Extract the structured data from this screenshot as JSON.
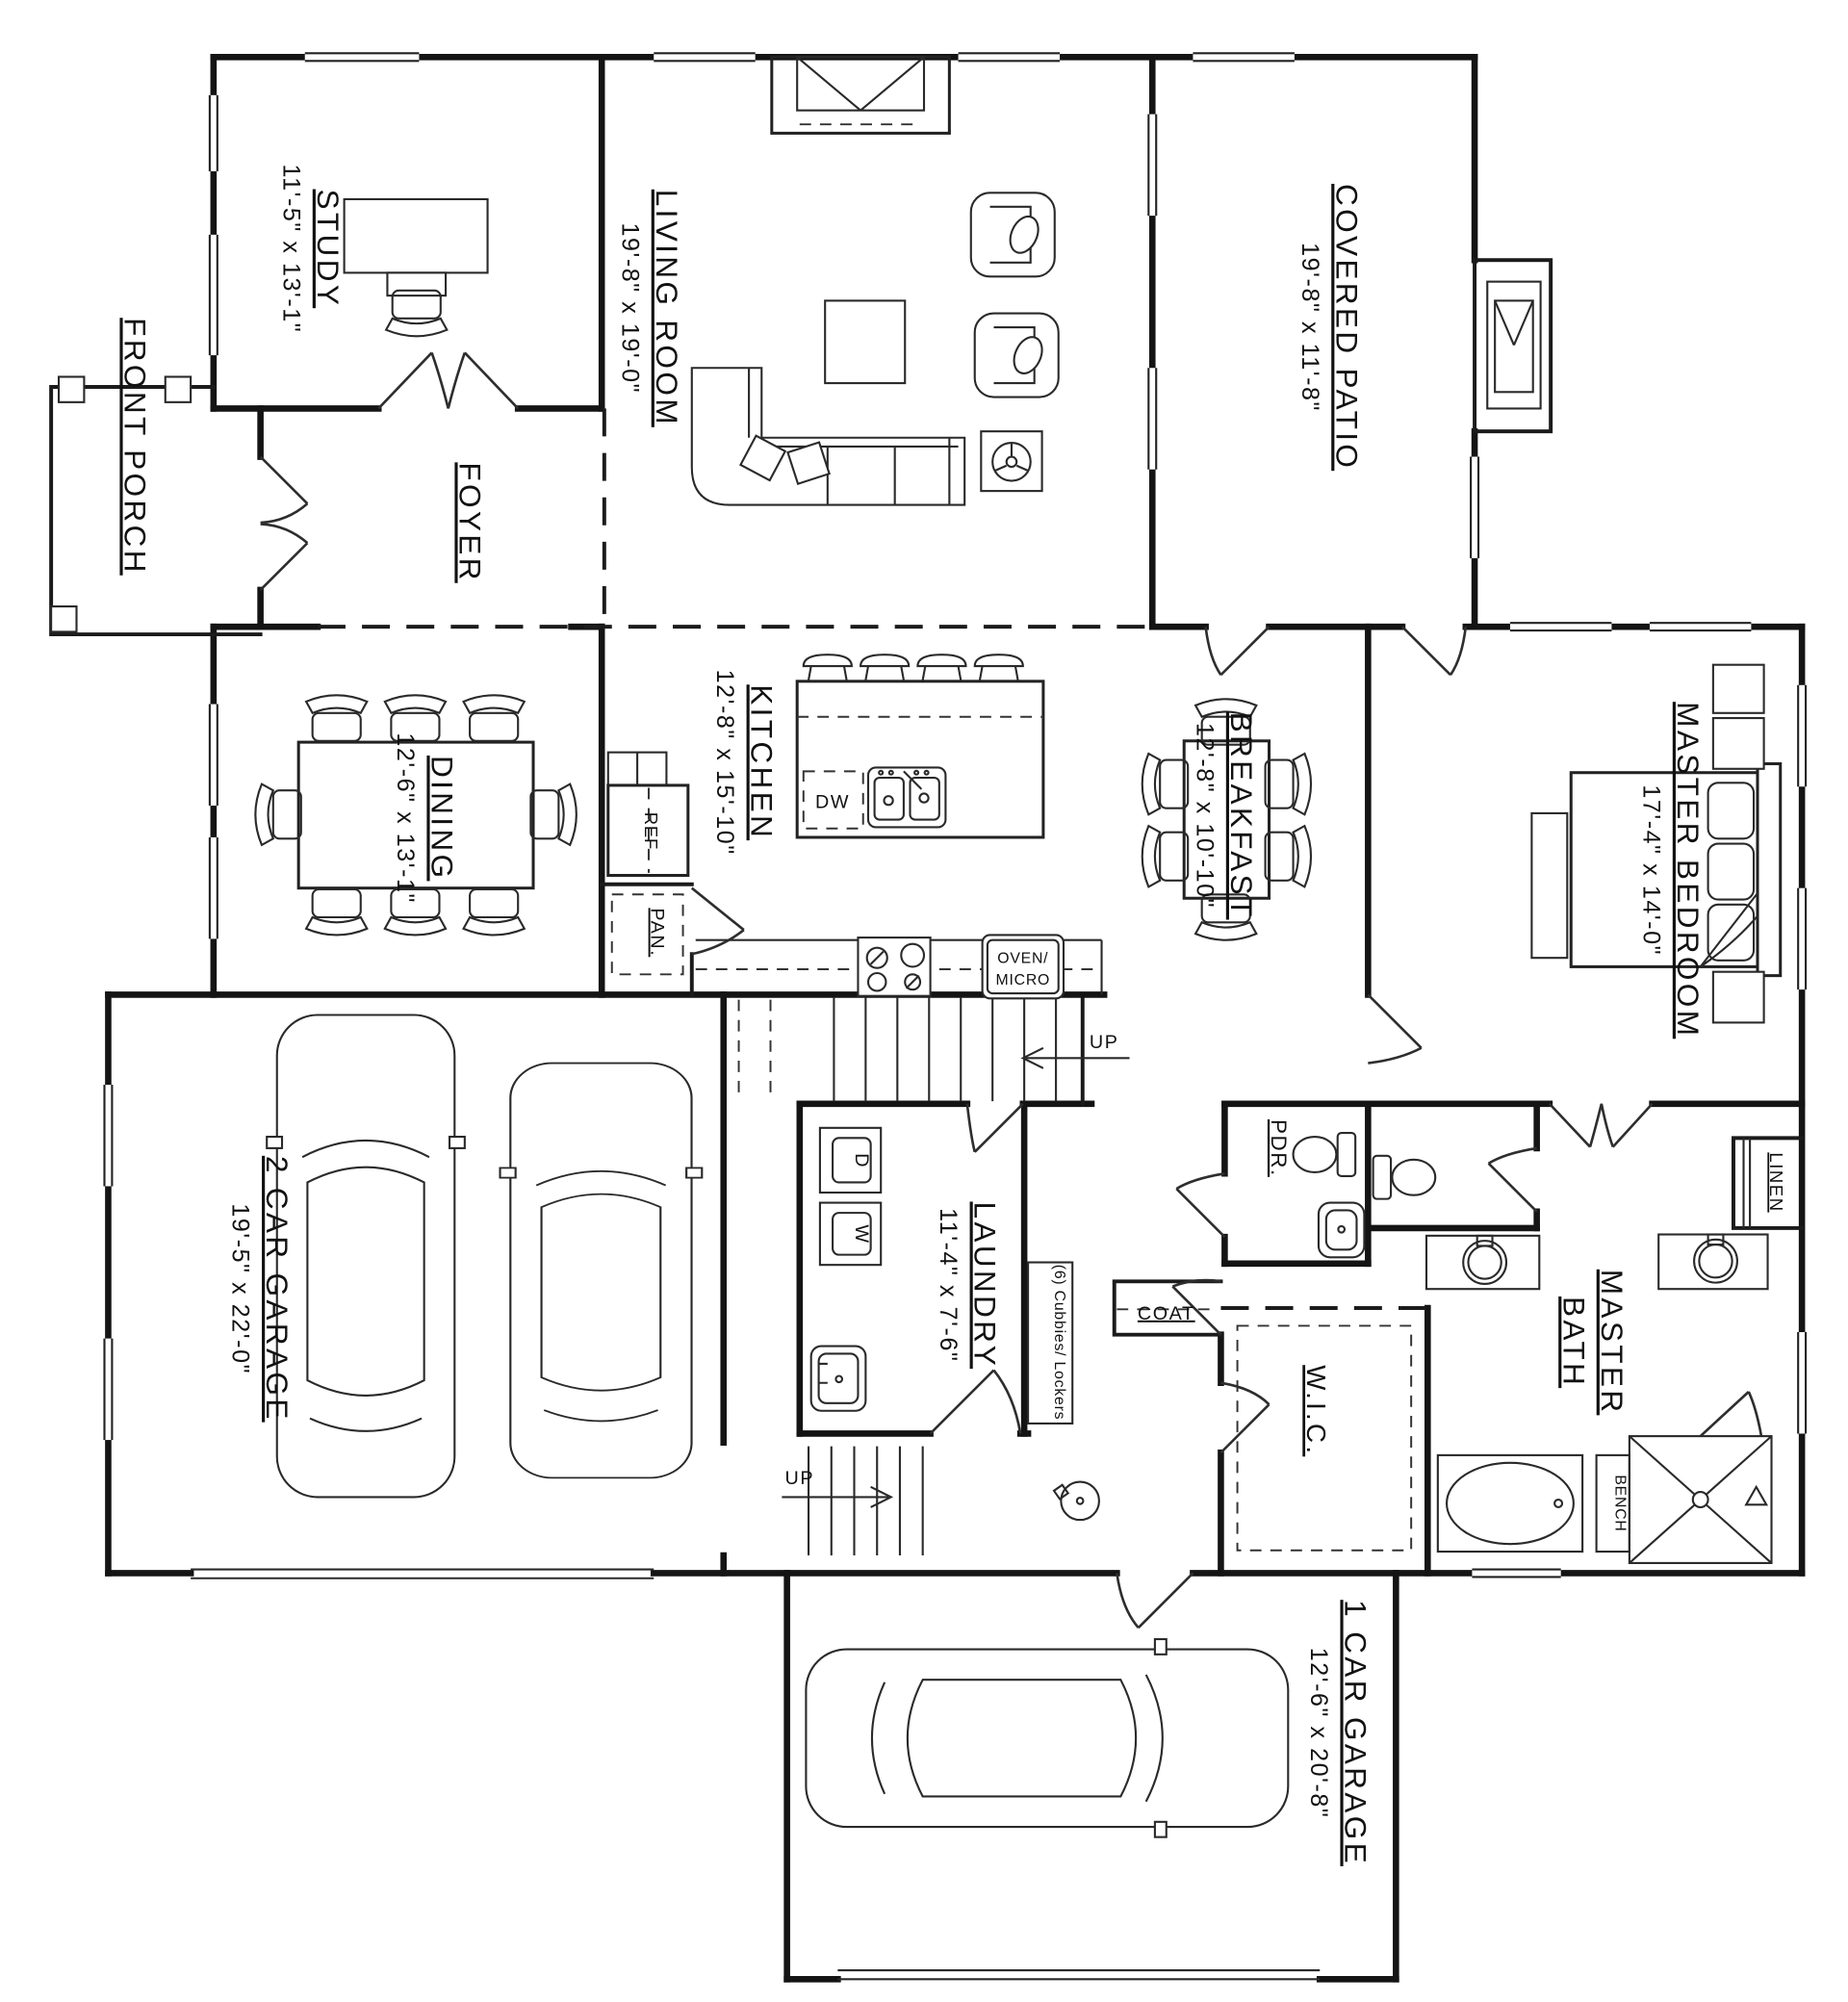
{
  "colors": {
    "line": "#1a1a1a",
    "background": "#ffffff"
  },
  "rooms": {
    "front_porch": {
      "name": "FRONT PORCH"
    },
    "study": {
      "name": "STUDY",
      "dims": "11'-5\" x 13'-1\""
    },
    "living_room": {
      "name": "LIVING ROOM",
      "dims": "19'-8\" x 19'-0\""
    },
    "covered_patio": {
      "name": "COVERED PATIO",
      "dims": "19'-8\" x 11'-8\""
    },
    "foyer": {
      "name": "FOYER"
    },
    "dining": {
      "name": "DINING",
      "dims": "12'-6\" x 13'-1\""
    },
    "kitchen": {
      "name": "KITCHEN",
      "dims": "12'-8\" x 15'-10\""
    },
    "breakfast": {
      "name": "BREAKFAST",
      "dims": "12'-8\" x 10'-10\""
    },
    "master_bedroom": {
      "name": "MASTER BEDROOM",
      "dims": "17'-4\" x 14'-0\""
    },
    "two_car_garage": {
      "name": "2 CAR GARAGE",
      "dims": "19'-5\" x 22'-0\""
    },
    "one_car_garage": {
      "name": "1 CAR GARAGE",
      "dims": "12'-6\" x 20'-8\""
    },
    "laundry": {
      "name": "LAUNDRY",
      "dims": "11'-4\" x 7'-6\""
    },
    "master_bath": {
      "line1": "MASTER",
      "line2": "BATH"
    },
    "wic": {
      "name": "W.I.C."
    },
    "powder": {
      "name": "PDR."
    },
    "coat": {
      "name": "COAT"
    },
    "linen": {
      "name": "LINEN"
    },
    "bench": {
      "name": "BENCH"
    }
  },
  "fixtures": {
    "refrigerator": "REF",
    "pantry": "PAN.",
    "dishwasher": "DW",
    "oven_line1": "OVEN/",
    "oven_line2": "MICRO",
    "washer": "W",
    "dryer": "D",
    "cubbies": "(6) Cubbies/ Lockers",
    "stairs_up": "UP"
  }
}
